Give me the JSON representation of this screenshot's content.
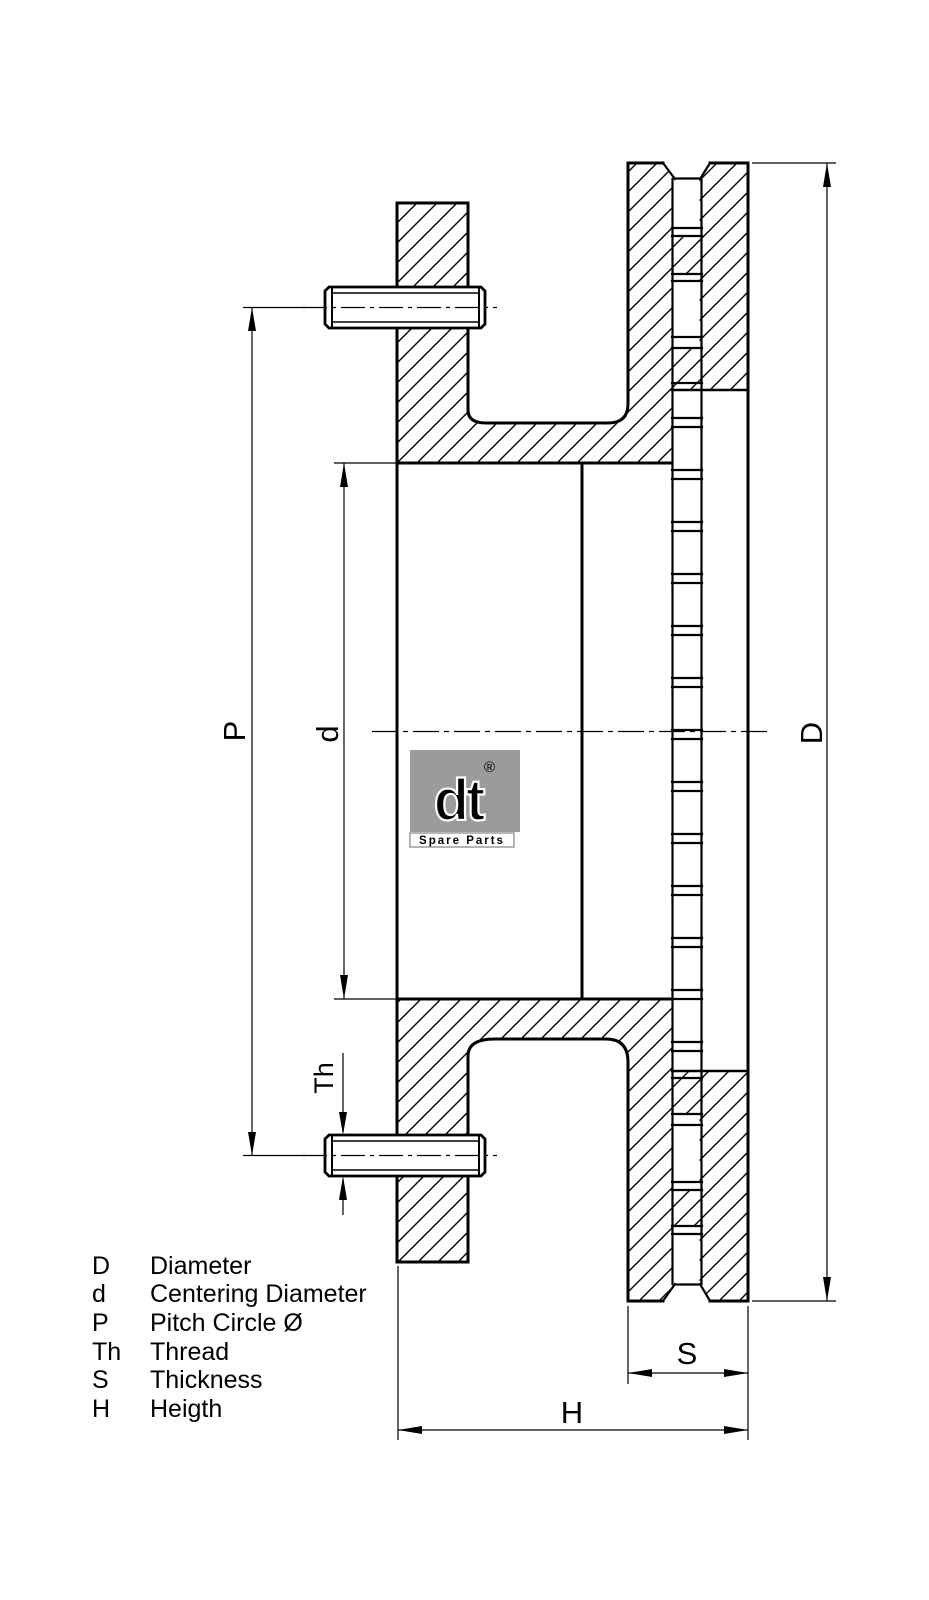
{
  "drawing": {
    "type": "technical-cross-section",
    "subject": "ventilated brake disc",
    "background_color": "#ffffff",
    "line_color": "#000000",
    "dimensions": {
      "diameter": {
        "label": "D"
      },
      "centering_diameter": {
        "label": "d"
      },
      "pitch_circle": {
        "label": "P"
      },
      "thread": {
        "label": "Th"
      },
      "thickness": {
        "label": "S"
      },
      "height": {
        "label": "H"
      }
    },
    "legend": {
      "rows": [
        {
          "key": "D",
          "value": "Diameter"
        },
        {
          "key": "d",
          "value": "Centering Diameter"
        },
        {
          "key": "P",
          "value": "Pitch Circle Ø"
        },
        {
          "key": "Th",
          "value": "Thread"
        },
        {
          "key": "S",
          "value": "Thickness"
        },
        {
          "key": "H",
          "value": "Heigth"
        }
      ]
    },
    "logo": {
      "brand": "dt",
      "registered": "®",
      "subtext": "Spare Parts",
      "color": "#9b9b9b"
    }
  }
}
